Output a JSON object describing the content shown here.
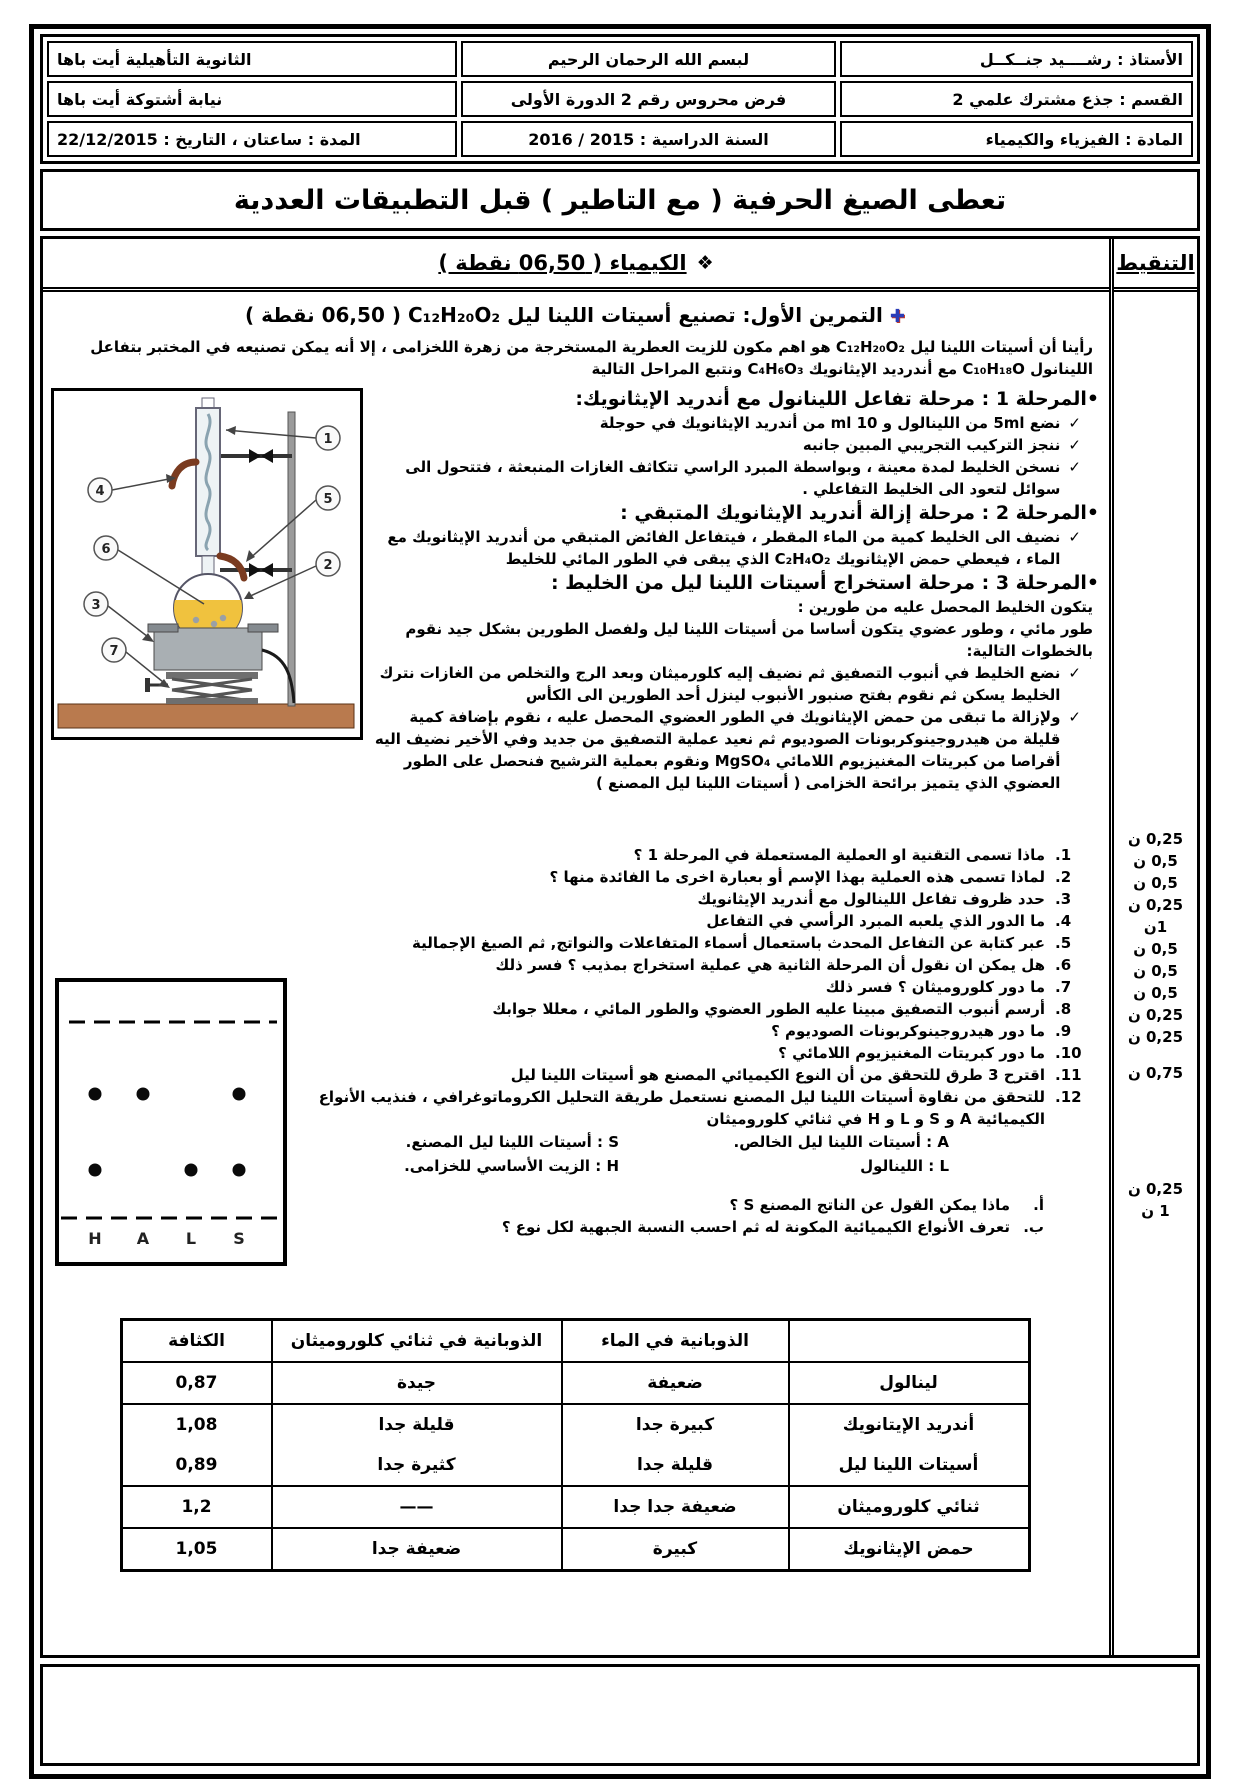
{
  "header": {
    "rows": [
      {
        "right": "الأستاذ : رشــــيد جنــكــل",
        "center": "لبسم الله الرحمان الرحيم",
        "left": "الثانوية التأهيلية أيت باها"
      },
      {
        "right": "القسم : جذع مشترك علمي 2",
        "center": "فرض محروس  رقم 2 الدورة الأولى",
        "left": "نيابة أشتوكة أيت باها"
      },
      {
        "right": "المادة : الفيزياء والكيمياء",
        "center": "السنة الدراسية : 2015 / 2016",
        "left": "المدة : ساعتان ، التاريخ : 22/12/2015"
      }
    ]
  },
  "banner": {
    "text": "تعطى الصيغ الحرفية ( مع التاطير ) قبل التطبيقات العددية"
  },
  "grading": {
    "title": "التنقيط",
    "marks": [
      "0,25 ن",
      "0,5 ن",
      "0,5 ن",
      "0,25 ن",
      "1ن",
      "0,5 ن",
      "0,5 ن",
      "0,5 ن",
      "0,25 ن",
      "0,25 ن",
      "0,75 ن",
      "0,25 ن",
      "1 ن"
    ]
  },
  "chemistry": {
    "section_bullet": "❖",
    "section_title": "الكيمياء ( 06,50 نقطة )",
    "exercise_icon": "✚",
    "exercise_title": "التمرين الأول: تصنيع   أسيتات اللينا ليل",
    "exercise_formula": "C₁₂H₂₀O₂",
    "exercise_points": "(   06,50 نقطة )",
    "intro": "رأينا أن أسيتات اللينا ليل  C₁₂H₂₀O₂  هو اهم مكون للزيت العطرية المستخرجة من زهرة اللخزامى ، إلا أنه يمكن تصنيعه في المختبر بتفاعل اللينانول  C₁₀H₁₈O  مع أندرديد الإيثانويك   C₄H₆O₃    ونتبع المراحل التالية",
    "check": "✓",
    "stage1": {
      "heading": "•المرحلة 1 : مرحلة تفاعل اللينانول مع أندريد الإيثانويك:",
      "items": [
        "نضع 5ml من اللينالول و  10 ml  من أندريد الإيثانويك في حوجلة",
        "ننجز التركيب التجريبي المبين جانبه",
        "نسخن الخليط لمدة معينة ، وبواسطة المبرد الراسي تتكاثف الغازات المنبعثة ، فتتحول الى سوائل لتعود الى الخليط التفاعلي ."
      ]
    },
    "stage2": {
      "heading": "•المرحلة 2 : مرحلة إزالة أندريد الإيثانويك المتبقي :",
      "items": [
        "نضيف الى  الخليط كمية من الماء المقطر ، فيتفاعل الفائض المتبقي من أندريد الإيثانويك مع الماء ، فيعطي حمض الإيثانويك   C₂H₄O₂   الذي يبقى في الطور المائي للخليط"
      ]
    },
    "stage3": {
      "heading": "•المرحلة 3 : مرحلة استخراج أسيتات اللينا ليل من الخليط :",
      "intro1": "يتكون الخليط المحصل عليه من طورين :",
      "intro2": "طور مائي ، وطور عضوي يتكون أساسا من أسيتات اللينا ليل ولفصل الطورين بشكل جيد نقوم بالخطوات التالية:",
      "items": [
        "نضع الخليط في أنبوب التصفيق ثم نضيف إليه كلورميثان وبعد الرج والتخلص من الغازات نترك الخليط يسكن ثم نقوم بفتح صنبور الأنبوب لينزل أحد الطورين الى الكأس",
        "ولإزالة ما تبقى من حمض الإيثانويك في الطور العضوي المحصل عليه ، نقوم بإضافة كمية قليلة من هيدروجينوكربونات الصوديوم ثم نعيد عملية التصفيق من جديد وفي الأخير نضيف اليه أقراصا من كبريتات المغنيزيوم اللامائي  MgSO₄  ونقوم بعملية الترشيح فنحصل على الطور العضوي الذي يتميز برائحة الخزامى   ( أسيتات اللينا ليل المصنع )"
      ]
    },
    "questions": [
      {
        "num": "1.",
        "text": "ماذا تسمى التقنية او العملية المستعملة في المرحلة 1 ؟"
      },
      {
        "num": "2.",
        "text": "لماذا تسمى هذه العملية بهذا الإسم أو بعبارة اخرى ما الفائدة منها ؟"
      },
      {
        "num": "3.",
        "text": "حدد ظروف تفاعل اللينالول مع أندريد الإيثانويك"
      },
      {
        "num": "4.",
        "text": "ما الدور الذي يلعبه المبرد الرأسي في التفاعل"
      },
      {
        "num": "5.",
        "text": "عبر كتابة عن التفاعل المحدث باستعمال أسماء المتفاعلات والنواتج, ثم الصيغ الإجمالية"
      },
      {
        "num": "6.",
        "text": "هل يمكن ان نقول أن المرحلة الثانية هي عملية استخراج بمذيب ؟ فسر ذلك"
      },
      {
        "num": "7.",
        "text": "ما دور كلوروميثان ؟  فسر ذلك"
      },
      {
        "num": "8.",
        "text": "أرسم أنبوب التصفيق مبينا عليه الطور العضوي والطور المائي ، معللا جوابك"
      },
      {
        "num": "9.",
        "text": "ما دور هيدروجينوكربونات الصوديوم  ؟"
      },
      {
        "num": "10.",
        "text": "ما دور كبريتات المغنيزيوم  اللامائي   ؟"
      },
      {
        "num": "11.",
        "text": "اقترح 3  طرق للتحقق من أن النوع الكيميائي المصنع هو أسيتات اللينا ليل"
      },
      {
        "num": "12.",
        "text": "للتحقق من نقاوة أسيتات اللينا ليل المصنع نستعمل طريقة التحليل الكروماتوغرافي ، فنذيب الأنواع الكيميائية  A و S و L و  H  في ثنائي كلوروميثان"
      }
    ],
    "legend": [
      {
        "right": "A : أسيتات اللينا ليل الخالص.",
        "left": "S : أسيتات اللينا ليل المصنع."
      },
      {
        "right": "L : اللينالول",
        "left": "H : الزيت الأساسي للخزامى."
      }
    ],
    "subquestions": [
      {
        "num": "أ.",
        "text": "ماذا يمكن القول عن الناتج المصنع S ؟"
      },
      {
        "num": "ب.",
        "text": "تعرف الأنواع الكيميائية المكونة له ثم احسب النسبة الجبهية لكل نوع ؟"
      }
    ],
    "figure_apparatus": {
      "labels": [
        "1",
        "4",
        "5",
        "6",
        "2",
        "3",
        "7"
      ]
    },
    "figure_plate": {
      "letters": [
        "H",
        "A",
        "L",
        "S"
      ]
    },
    "table": {
      "headers": {
        "name": "",
        "water": "الذوبانية في الماء",
        "dcm": "الذوبانية في ثنائي كلوروميثان",
        "density": "الكثافة"
      },
      "rows": [
        {
          "name": "لينالول",
          "water": "ضعيفة",
          "dcm": "جيدة",
          "density": "0,87"
        },
        {
          "name": "أندريد الإيتانويك",
          "water": "كبيرة جدا",
          "dcm": "قليلة جدا",
          "density": "1,08"
        },
        {
          "name": "أسيتات اللينا ليل",
          "water": "قليلة جدا",
          "dcm": "كثيرة جدا",
          "density": "0,89"
        },
        {
          "name": "ثنائي كلوروميثان",
          "water": "ضعيفة جدا جدا",
          "dcm": "——",
          "density": "1,2"
        },
        {
          "name": "حمض الإيثانويك",
          "water": "كبيرة",
          "dcm": "ضعيفة جدا",
          "density": "1,05"
        }
      ]
    }
  }
}
